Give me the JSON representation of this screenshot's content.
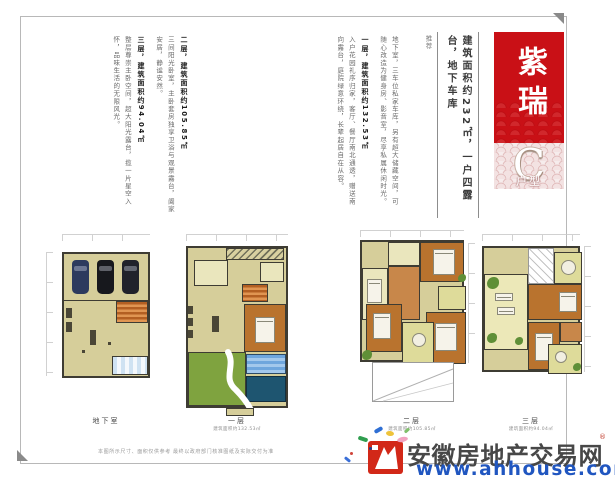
{
  "brand": {
    "name": "紫瑞",
    "unit_letter": "C",
    "unit_label": "户型"
  },
  "tagline": {
    "main": "建筑面积约232㎡，一户四露台，地下车库",
    "note": "推荐"
  },
  "intro": {
    "paragraphs": [
      {
        "heading": "",
        "body": "地下室，三车位私家车库，另有超大储藏空间，可随心改造为健身房、影音室，尽享私属休闲时光。"
      },
      {
        "heading": "一层，建筑面积约132.53㎡",
        "body": "入户花园礼序归家，客厅、餐厅南北通透，赠送南向露台，庭院绿意环绕，长辈起居自在从容。"
      },
      {
        "heading": "二层，建筑面积约105.85㎡",
        "body": "三间阳光卧室，主卧套房独享卫浴与观景露台，阖家安居，静谧安然。"
      },
      {
        "heading": "三层，建筑面积约94.04㎡",
        "body": "整层尊崇主卧空间，超大阳光露台，揽一片星空入怀，品味生活的无限风光。"
      }
    ]
  },
  "plans": [
    {
      "label": "地下室",
      "area": ""
    },
    {
      "label": "一层",
      "area": "建筑面积约132.53㎡"
    },
    {
      "label": "二层",
      "area": "建筑面积约105.85㎡"
    },
    {
      "label": "三层",
      "area": "建筑面积约94.04㎡"
    }
  ],
  "watermark": {
    "site": "安徽房地产交易网",
    "url": "www.ahhouse.com",
    "reg": "®"
  },
  "disclaimer": {
    "text": "本图所示尺寸、面积仅供参考  最终以政府部门核准图纸及实际交付为准"
  },
  "colors": {
    "brand_red": "#c91016",
    "pattern_pink": "#dcb0b0",
    "link_blue": "#2056c0",
    "site_gray": "#474747",
    "floor_tan": "#d6ce9a",
    "wood_orange": "#b9732e",
    "garden_green": "#7fa33f",
    "pool_blue": "#6fa6dd"
  }
}
